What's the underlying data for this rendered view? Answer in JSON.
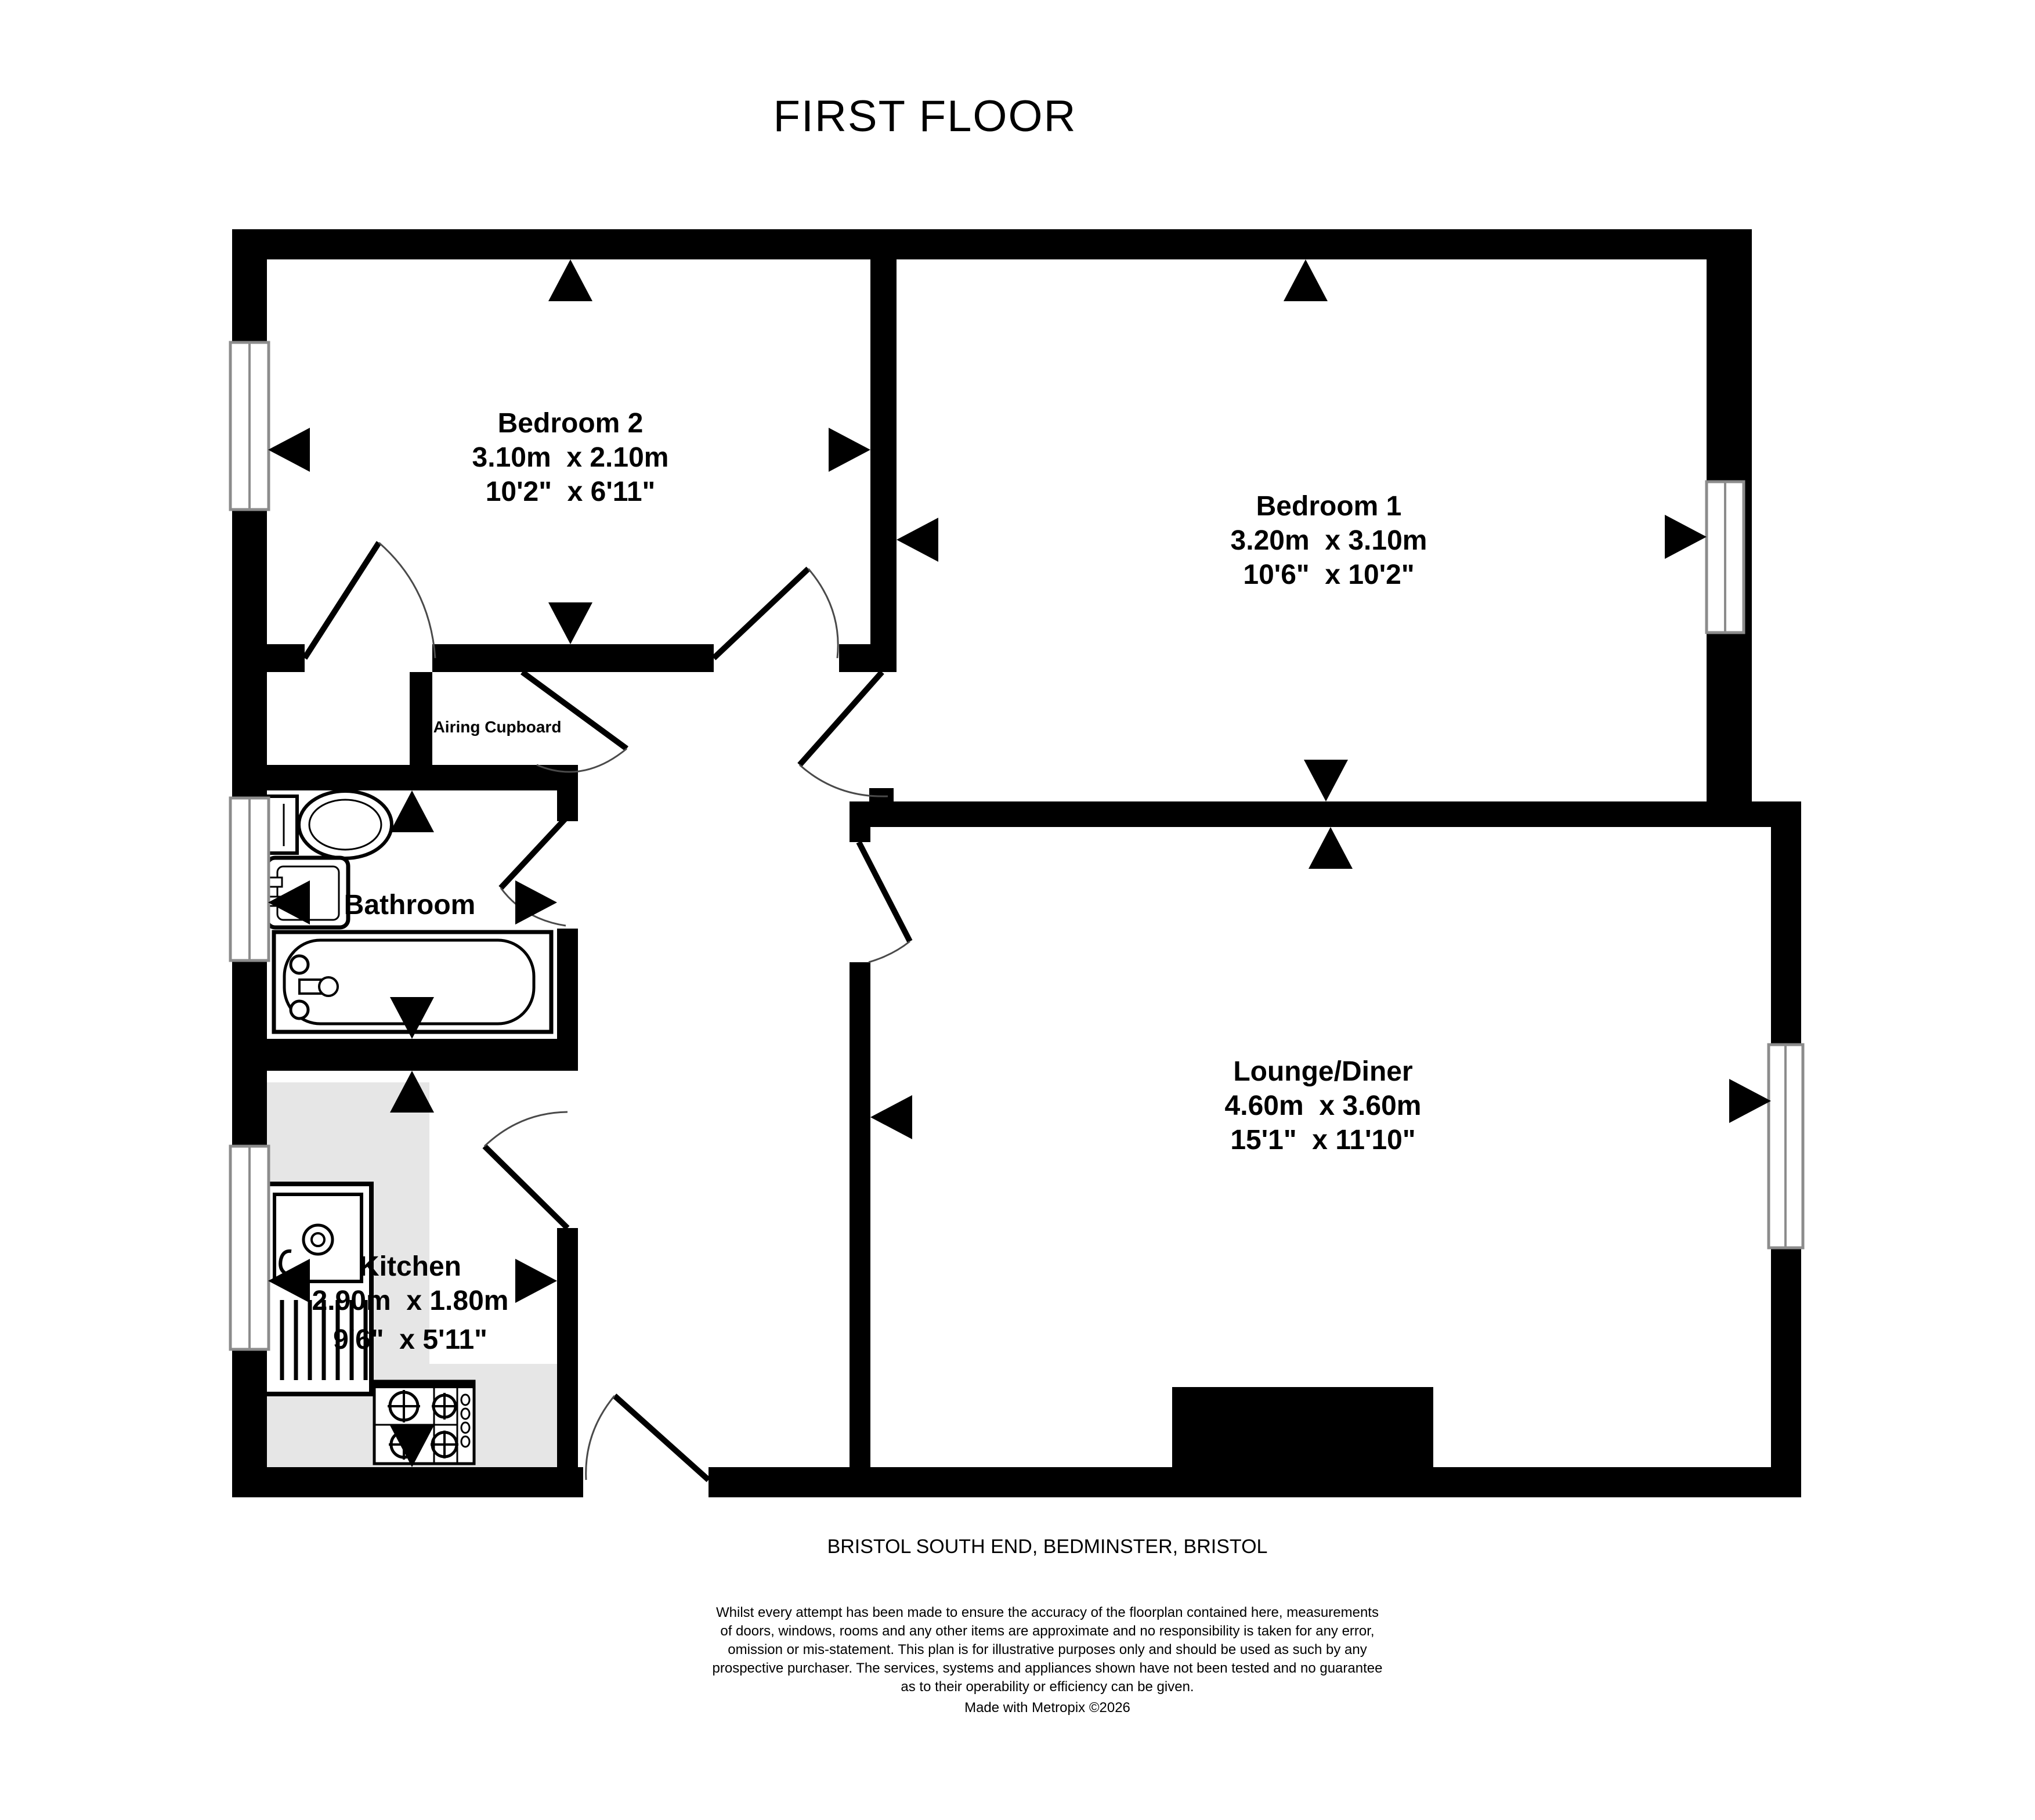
{
  "title": "FIRST FLOOR",
  "address": "BRISTOL SOUTH END, BEDMINSTER, BRISTOL",
  "rooms": {
    "bedroom2": {
      "name": "Bedroom 2",
      "metric": "3.10m  x 2.10m",
      "imperial": "10'2\"  x 6'11\""
    },
    "bedroom1": {
      "name": "Bedroom 1",
      "metric": "3.20m  x 3.10m",
      "imperial": "10'6\"  x 10'2\""
    },
    "lounge": {
      "name": "Lounge/Diner",
      "metric": "4.60m  x 3.60m",
      "imperial": "15'1\"  x 11'10\""
    },
    "kitchen": {
      "name": "Kitchen",
      "metric": "2.90m  x 1.80m",
      "imperial": "9'6\"  x 5'11\""
    },
    "bathroom": {
      "name": "Bathroom"
    },
    "airing_cupboard": {
      "name": "Airing Cupboard"
    }
  },
  "footer": {
    "disclaimer": [
      "Whilst every attempt has been made to ensure the accuracy of the floorplan contained here, measurements",
      "of doors, windows, rooms and any other items are approximate and no responsibility is taken for any error,",
      "omission or mis-statement. This plan is for illustrative purposes only and should be used as such by any",
      "prospective purchaser. The services, systems and appliances shown have not been tested and no guarantee",
      "as to their operability or efficiency can be given.",
      "Made with Metropix ©2026"
    ]
  },
  "colors": {
    "wall": "#000000",
    "counter": "#e6e6e6",
    "window_frame": "#8c8c8c",
    "door_arc": "#4a4a4a",
    "fireplace": "#000000"
  },
  "fixtures": [
    "toilet",
    "bathroom-sink",
    "bathtub",
    "kitchen-sink",
    "stove",
    "fireplace"
  ]
}
